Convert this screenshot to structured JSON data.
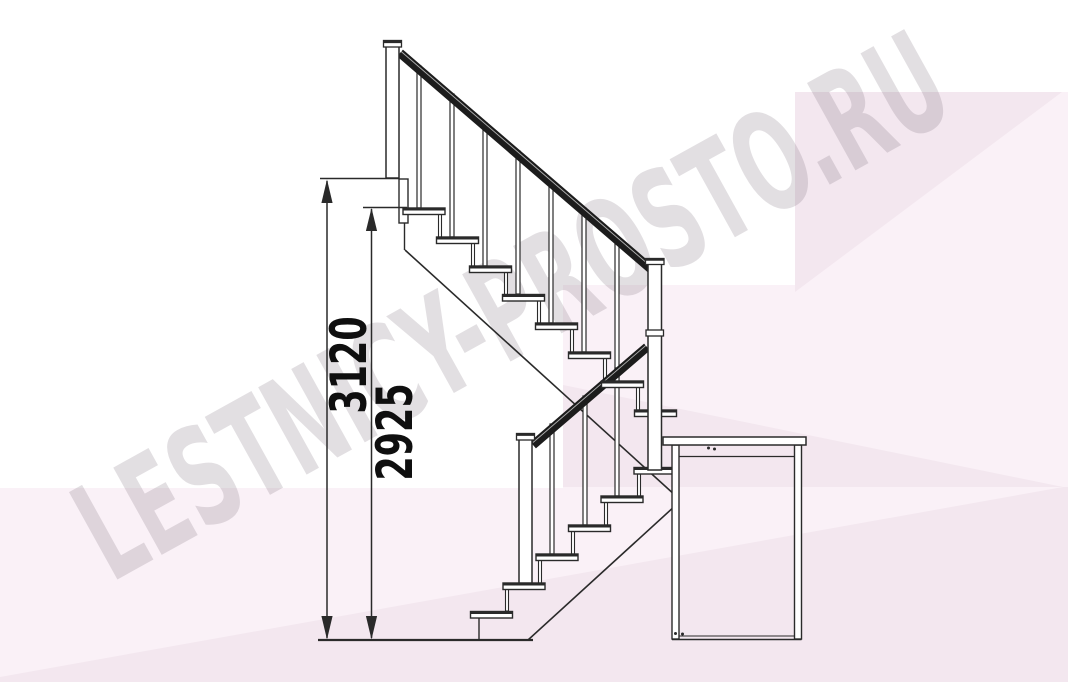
{
  "page": {
    "title": "Staircase side elevation drawing",
    "width_px": 1068,
    "height_px": 682
  },
  "watermark": {
    "text": "LESTNICY-PROSTO.RU"
  },
  "dimensions": {
    "total_height": {
      "value": "3120"
    },
    "height_to_top_tread": {
      "value": "2925"
    }
  },
  "drawing": {
    "type": "stair-side-elevation",
    "upper_flight_tread_count": 8,
    "lower_flight_tread_count": 6,
    "has_support_cabinet": true,
    "handrail_sides": "single"
  },
  "colors": {
    "ink": "#2a2a2a",
    "handrail": "#1c1c1c",
    "dimension_text": "#0f0f0f",
    "background_pink_light": "#faf1f7",
    "background_pink_deep": "#f3e7ef",
    "watermark": "rgba(125,110,122,0.22)",
    "paper": "#ffffff"
  }
}
